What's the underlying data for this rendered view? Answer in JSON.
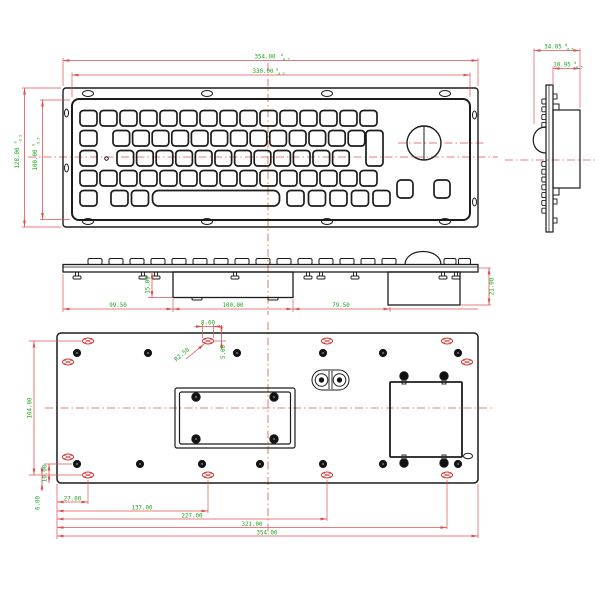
{
  "colors": {
    "outline": "#1c1c1c",
    "dimension": "#e05252",
    "dim_text": "#1fa31f",
    "hatch": "#cc3333"
  },
  "tolerance": {
    "upper": "0",
    "lower": "-0.5"
  },
  "views": {
    "top": {
      "dims": {
        "width_outer": "354.00",
        "width_inner": "330.00",
        "height_outer": "128.00",
        "height_inner": "100.00"
      }
    },
    "side": {
      "dims": {
        "depth_total": "34.05",
        "depth_rear": "10.95"
      }
    },
    "front_profile": {
      "dims": {
        "seg_left": "99.50",
        "seg_center": "100.00",
        "seg_right": "79.50",
        "height_center_box": "15.00",
        "height_right_box": "21.00"
      }
    },
    "back": {
      "dims": {
        "slot_length": "8.00",
        "slot_center_offset": "5.00",
        "slot_radius": "R2.50",
        "x_27": "27.00",
        "x_137": "137.00",
        "x_227": "227.00",
        "x_321": "321.00",
        "x_354": "354.00",
        "y_104": "104.00",
        "y_10": "10.00",
        "y_6": "6.00"
      }
    }
  }
}
